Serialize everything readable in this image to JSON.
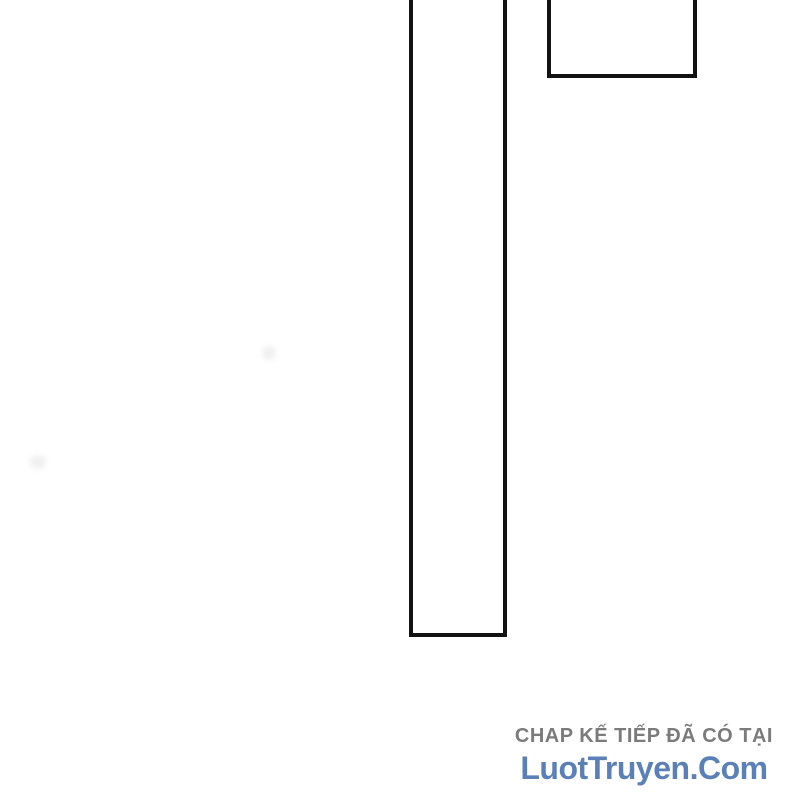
{
  "page": {
    "background_color": "#ffffff",
    "panel_border_color": "#121212"
  },
  "watermark": {
    "tagline": "CHAP KẾ TIẾP ĐÃ CÓ TẠI",
    "site_name": "LuotTruyen.Com",
    "tagline_color": "#7b7b7b",
    "site_name_color": "#5b80b7"
  }
}
